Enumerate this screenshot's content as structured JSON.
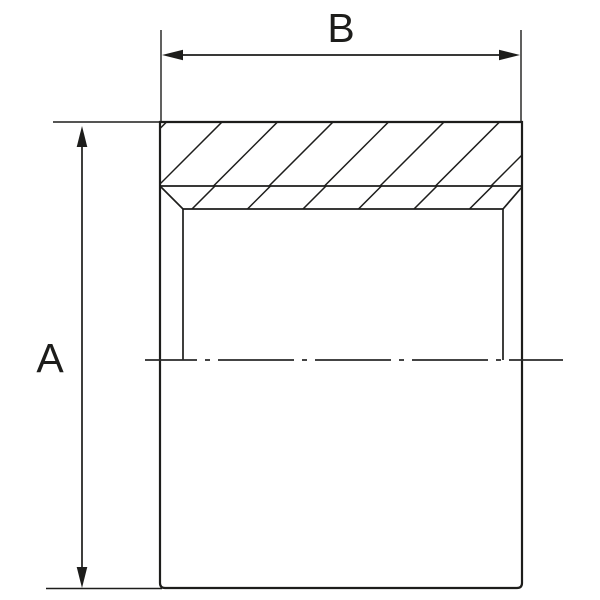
{
  "drawing": {
    "description": "Sectioned technical drawing of a cylindrical sleeve with a counterbored/chamfered opening, hatched section band at top, bore walls down to a dash-dot centerline, and two dimension callouts",
    "dim_labels": {
      "height": "A",
      "width": "B"
    },
    "dimensions": [
      {
        "label": "A",
        "orientation": "vertical",
        "spans": "overall height of part"
      },
      {
        "label": "B",
        "orientation": "horizontal",
        "spans": "overall width of part"
      }
    ],
    "colors": {
      "line": "#1d1d1b",
      "centerline": "#2a2a2a",
      "background": "#ffffff"
    }
  }
}
